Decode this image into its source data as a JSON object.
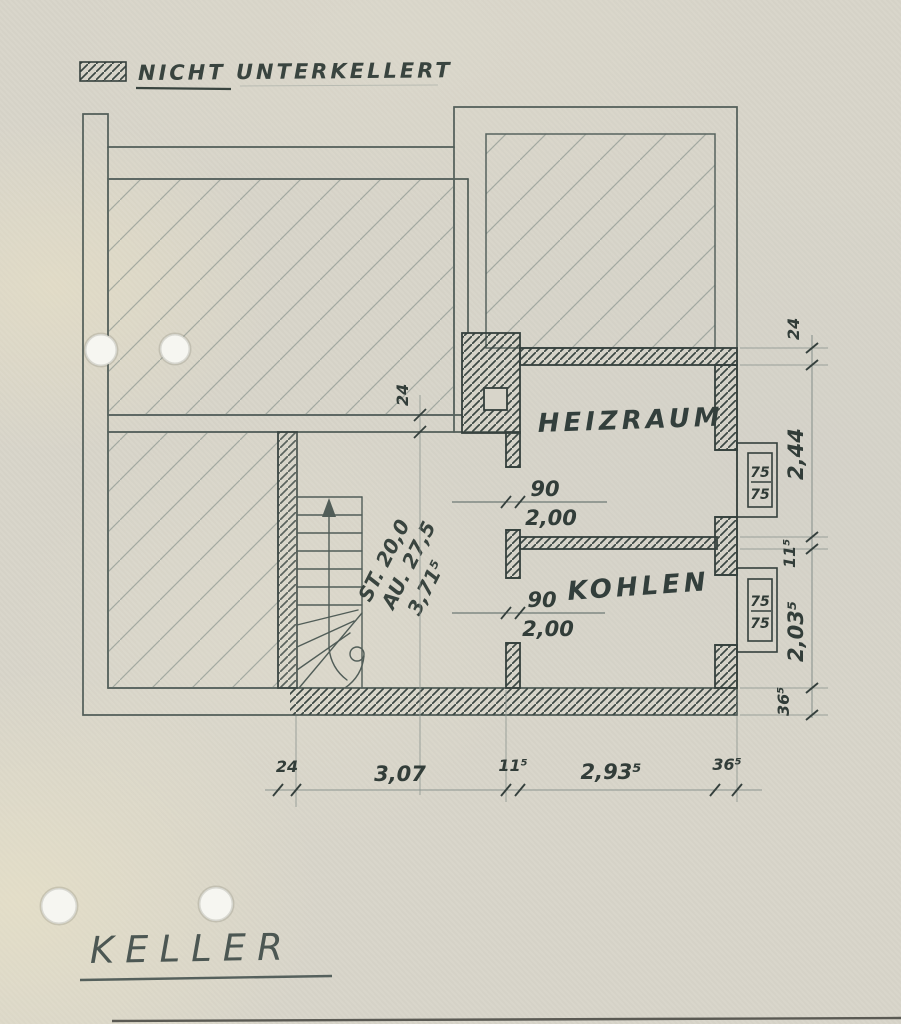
{
  "document": {
    "type_label": "KELLER",
    "legend_label": "NICHT UNTERKELLERT"
  },
  "rooms": {
    "heizraum": {
      "name": "HEIZRAUM"
    },
    "kohlen": {
      "name": "KOHLEN"
    }
  },
  "stairs": {
    "riser_note": "ST. 20,0",
    "tread_note": "AU. 27,5",
    "run_length": "3,71⁵"
  },
  "doors": {
    "heizraum_door": {
      "width_cm": "90",
      "height_m": "2,00"
    },
    "kohlen_door": {
      "width_cm": "90",
      "height_m": "2,00"
    }
  },
  "windows": {
    "upper": {
      "width_cm": "75",
      "height_cm": "75"
    },
    "lower": {
      "width_cm": "75",
      "height_cm": "75"
    }
  },
  "dimensions": {
    "wall_thickness_top": "24",
    "bottom_chain": [
      "24",
      "3,07",
      "11⁵",
      "2,93⁵",
      "36⁵"
    ],
    "right_chain": [
      "24",
      "2,44",
      "11⁵",
      "2,03⁵",
      "36⁵"
    ]
  },
  "colors": {
    "paper": "#d8d5ca",
    "ink_dark": "#35403d",
    "ink_medium": "#515d58",
    "ink_light": "#8b948f"
  }
}
